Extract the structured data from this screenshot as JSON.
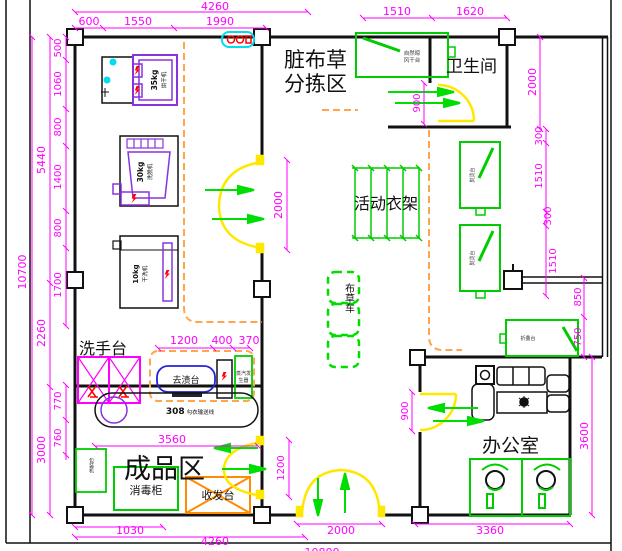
{
  "drawing_title": "洗衣房平面布置图",
  "rooms": {
    "sorting_line1": "脏布草",
    "sorting_line2": "分拣区",
    "bathroom": "卫生间",
    "rack": "活动衣架",
    "washstand": "洗手台",
    "finished": "成品区",
    "office": "办公室"
  },
  "equipment": {
    "dryer_cap": "35kg",
    "dryer": "烘干机",
    "washer_cap": "30kg",
    "washer": "洗脱机",
    "dry_cap": "10kg",
    "dry": "干洗机",
    "stain": "去渍台",
    "steam1": "蒸汽发",
    "steam2": "生器",
    "airdry1": "自然晾",
    "airdry2": "风干台",
    "conveyor_model": "308",
    "conveyor": "勾衣输送线",
    "disinfect": "消毒柜",
    "desk": "收发台",
    "cart": "布草车",
    "pack": "包装机",
    "iron": "熨烫台",
    "fold": "折叠台"
  },
  "dims": {
    "t4260": "4260",
    "t600": "600",
    "t1550": "1550",
    "t1990": "1990",
    "t1510": "1510",
    "t1620": "1620",
    "l10700": "10700",
    "l5440": "5440",
    "l2260": "2260",
    "l3000": "3000",
    "l500": "500",
    "l1060": "1060",
    "l800a": "800",
    "l1400": "1400",
    "l800b": "800",
    "l1700": "1700",
    "l770": "770",
    "l760": "760",
    "r2000": "2000",
    "r300a": "300",
    "r1510a": "1510",
    "r300b": "300",
    "r1510b": "1510",
    "r850": "850",
    "r750": "750",
    "r3600": "3600",
    "d2000": "2000",
    "d900bath": "900",
    "d1200": "1200",
    "d900office": "900",
    "i1200": "1200",
    "i400": "400",
    "i370": "370",
    "i3560": "3560",
    "b1030": "1030",
    "b4260": "4260",
    "b2000": "2000",
    "b3360": "3360",
    "b10800": "10800"
  },
  "colors": {
    "dimension": "#FF00FF",
    "wall": "#111111",
    "door": "#FFE800",
    "flow_arrow": "#00DD00",
    "equipment_green": "#00CC00",
    "machine_purple": "#8833DD",
    "zone_dashed": "#FFA64D",
    "desk_orange": "#FF8C00",
    "stain_blue": "#2222DD",
    "sign_cyan": "#00DDEE",
    "power_red": "#FF0000"
  }
}
